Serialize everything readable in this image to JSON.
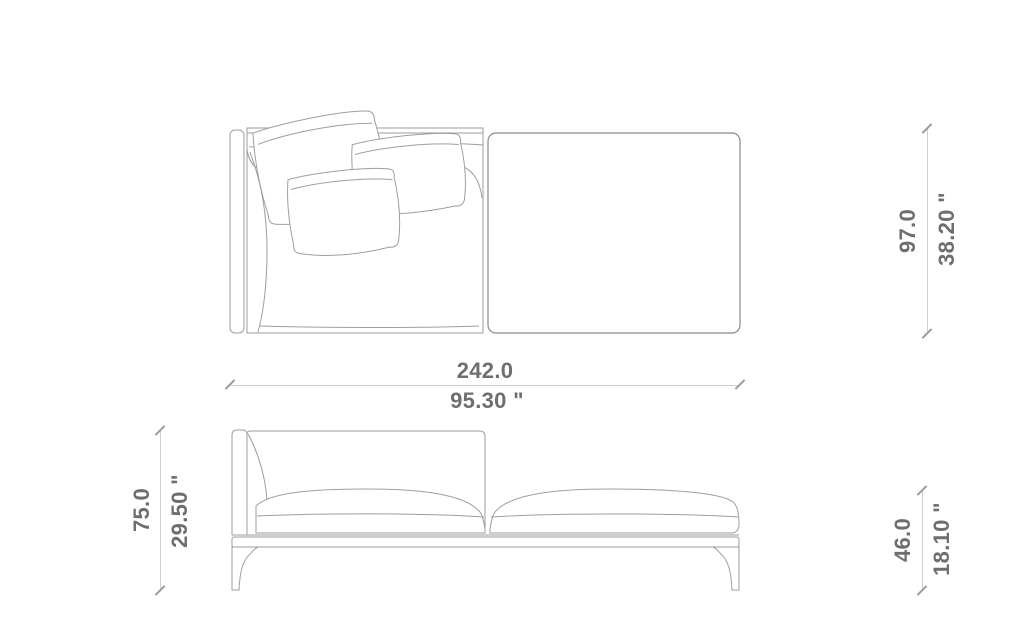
{
  "page": {
    "type": "furniture-dimension-technical-drawing",
    "background": "#ffffff"
  },
  "views": {
    "top_view": "sofa plan view with left arm, three back cushions and chaise seat",
    "front_view": "sofa front elevation with left backrest, two seat cushions, base rail and tapered legs"
  },
  "dimensions": {
    "width": {
      "cm": "242.0",
      "inches": "95.30 \""
    },
    "depth": {
      "cm": "97.0",
      "inches": "38.20 \""
    },
    "height": {
      "cm": "75.0",
      "inches": "29.50 \""
    },
    "seat_height": {
      "cm": "46.0",
      "inches": "18.10 \""
    }
  },
  "colors": {
    "dimension_text": "#6e6e6e",
    "dimension_line": "#cfcfcf",
    "tick_mark": "#9b9b9b",
    "drawing_stroke": "#9e9e9e",
    "background": "#ffffff"
  }
}
